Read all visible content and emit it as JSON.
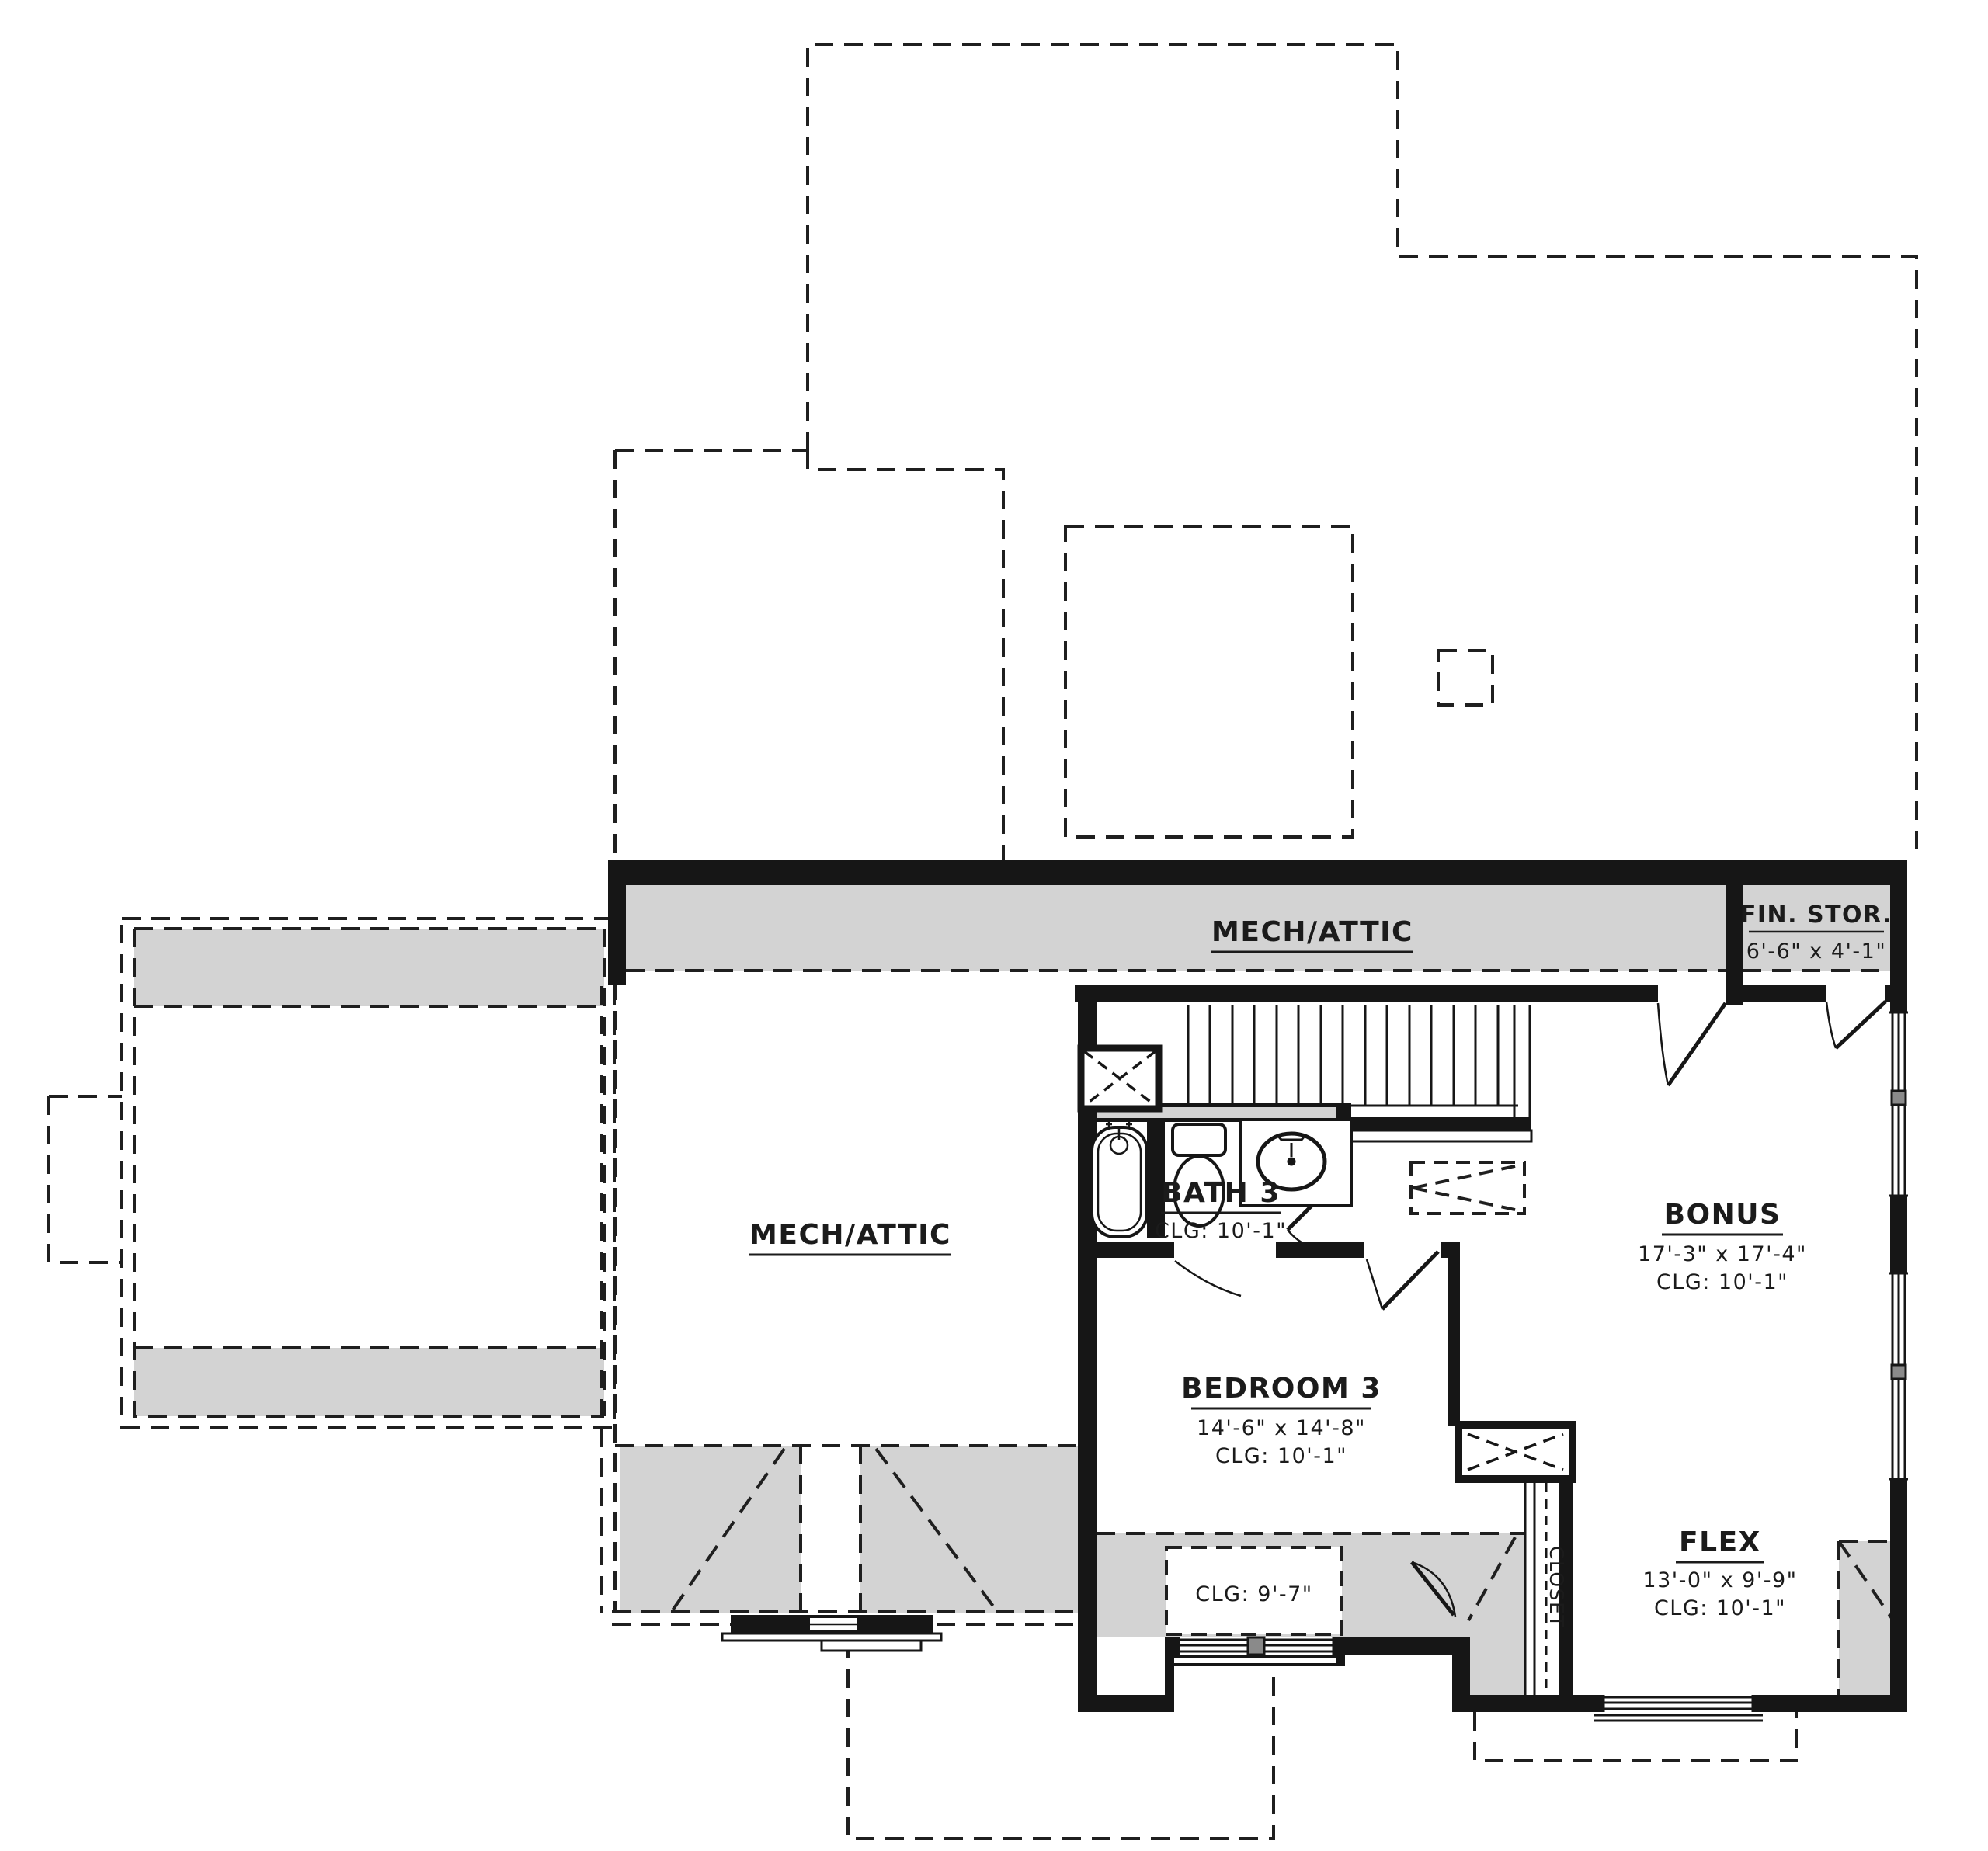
{
  "plan": {
    "type": "floor-plan",
    "colors": {
      "wall": "#161616",
      "wall_core": "#7d7d7d",
      "shade_gray": "#d3d3d3",
      "dash_line": "#1f1f1f",
      "background": "#ffffff"
    },
    "rooms": [
      {
        "id": "mech-attic-top",
        "name": "MECH/ATTIC",
        "dims": "",
        "clg": ""
      },
      {
        "id": "fin-stor",
        "name": "FIN. STOR.",
        "dims": "6'-6\" x 4'-1\"",
        "clg": ""
      },
      {
        "id": "mech-attic-left",
        "name": "MECH/ATTIC",
        "dims": "",
        "clg": ""
      },
      {
        "id": "bath-3",
        "name": "BATH 3",
        "dims": "",
        "clg": "CLG: 10'-1\""
      },
      {
        "id": "bonus",
        "name": "BONUS",
        "dims": "17'-3\" x 17'-4\"",
        "clg": "CLG: 10'-1\""
      },
      {
        "id": "bedroom-3",
        "name": "BEDROOM 3",
        "dims": "14'-6\" x 14'-8\"",
        "clg": "CLG: 10'-1\""
      },
      {
        "id": "flex",
        "name": "FLEX",
        "dims": "13'-0\" x 9'-9\"",
        "clg": "CLG: 10'-1\""
      },
      {
        "id": "closet",
        "name": "CLOSET",
        "dims": "",
        "clg": ""
      }
    ],
    "annotations": {
      "ceiling_break": "CLG: 9'-7\""
    },
    "symbols": [
      "stairs",
      "tub",
      "toilet",
      "vanity-sink",
      "shower",
      "linen-cabinet",
      "attic-access",
      "windows",
      "doors",
      "roof-outline-dashed"
    ]
  }
}
